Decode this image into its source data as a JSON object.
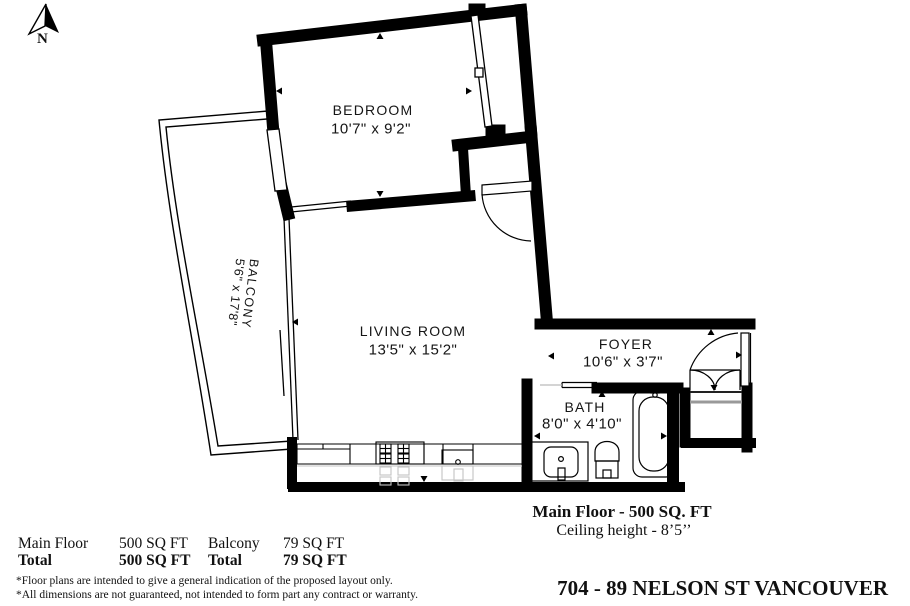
{
  "compass": {
    "label": "N"
  },
  "rooms": {
    "bedroom": {
      "name": "BEDROOM",
      "dims": "10'7\" x 9'2\""
    },
    "living": {
      "name": "LIVING ROOM",
      "dims": "13'5\" x 15'2\""
    },
    "foyer": {
      "name": "FOYER",
      "dims": "10'6\" x 3'7\""
    },
    "bath": {
      "name": "BATH",
      "dims": "8'0\" x 4'10\""
    },
    "balcony": {
      "name": "BALCONY",
      "dims": "5'6\" x 17'8\""
    }
  },
  "floor_info": {
    "main_area": "Main Floor - 500 SQ. FT",
    "ceiling": "Ceiling height - 8’5’’"
  },
  "summary": {
    "rows": [
      {
        "c1": "Main Floor",
        "c2": "500 SQ FT",
        "c3": "Balcony",
        "c4": "79 SQ FT"
      },
      {
        "c1": "Total",
        "c2": "500 SQ FT",
        "c3": "Total",
        "c4": "79 SQ FT"
      }
    ]
  },
  "notes": [
    "*Floor plans are intended to give a general indication of the proposed layout only.",
    "*All dimensions are not guaranteed, not intended to form part any contract or warranty."
  ],
  "address": "704 - 89 NELSON ST VANCOUVER",
  "colors": {
    "ink": "#000000",
    "ghost": "#c4c4c4"
  }
}
